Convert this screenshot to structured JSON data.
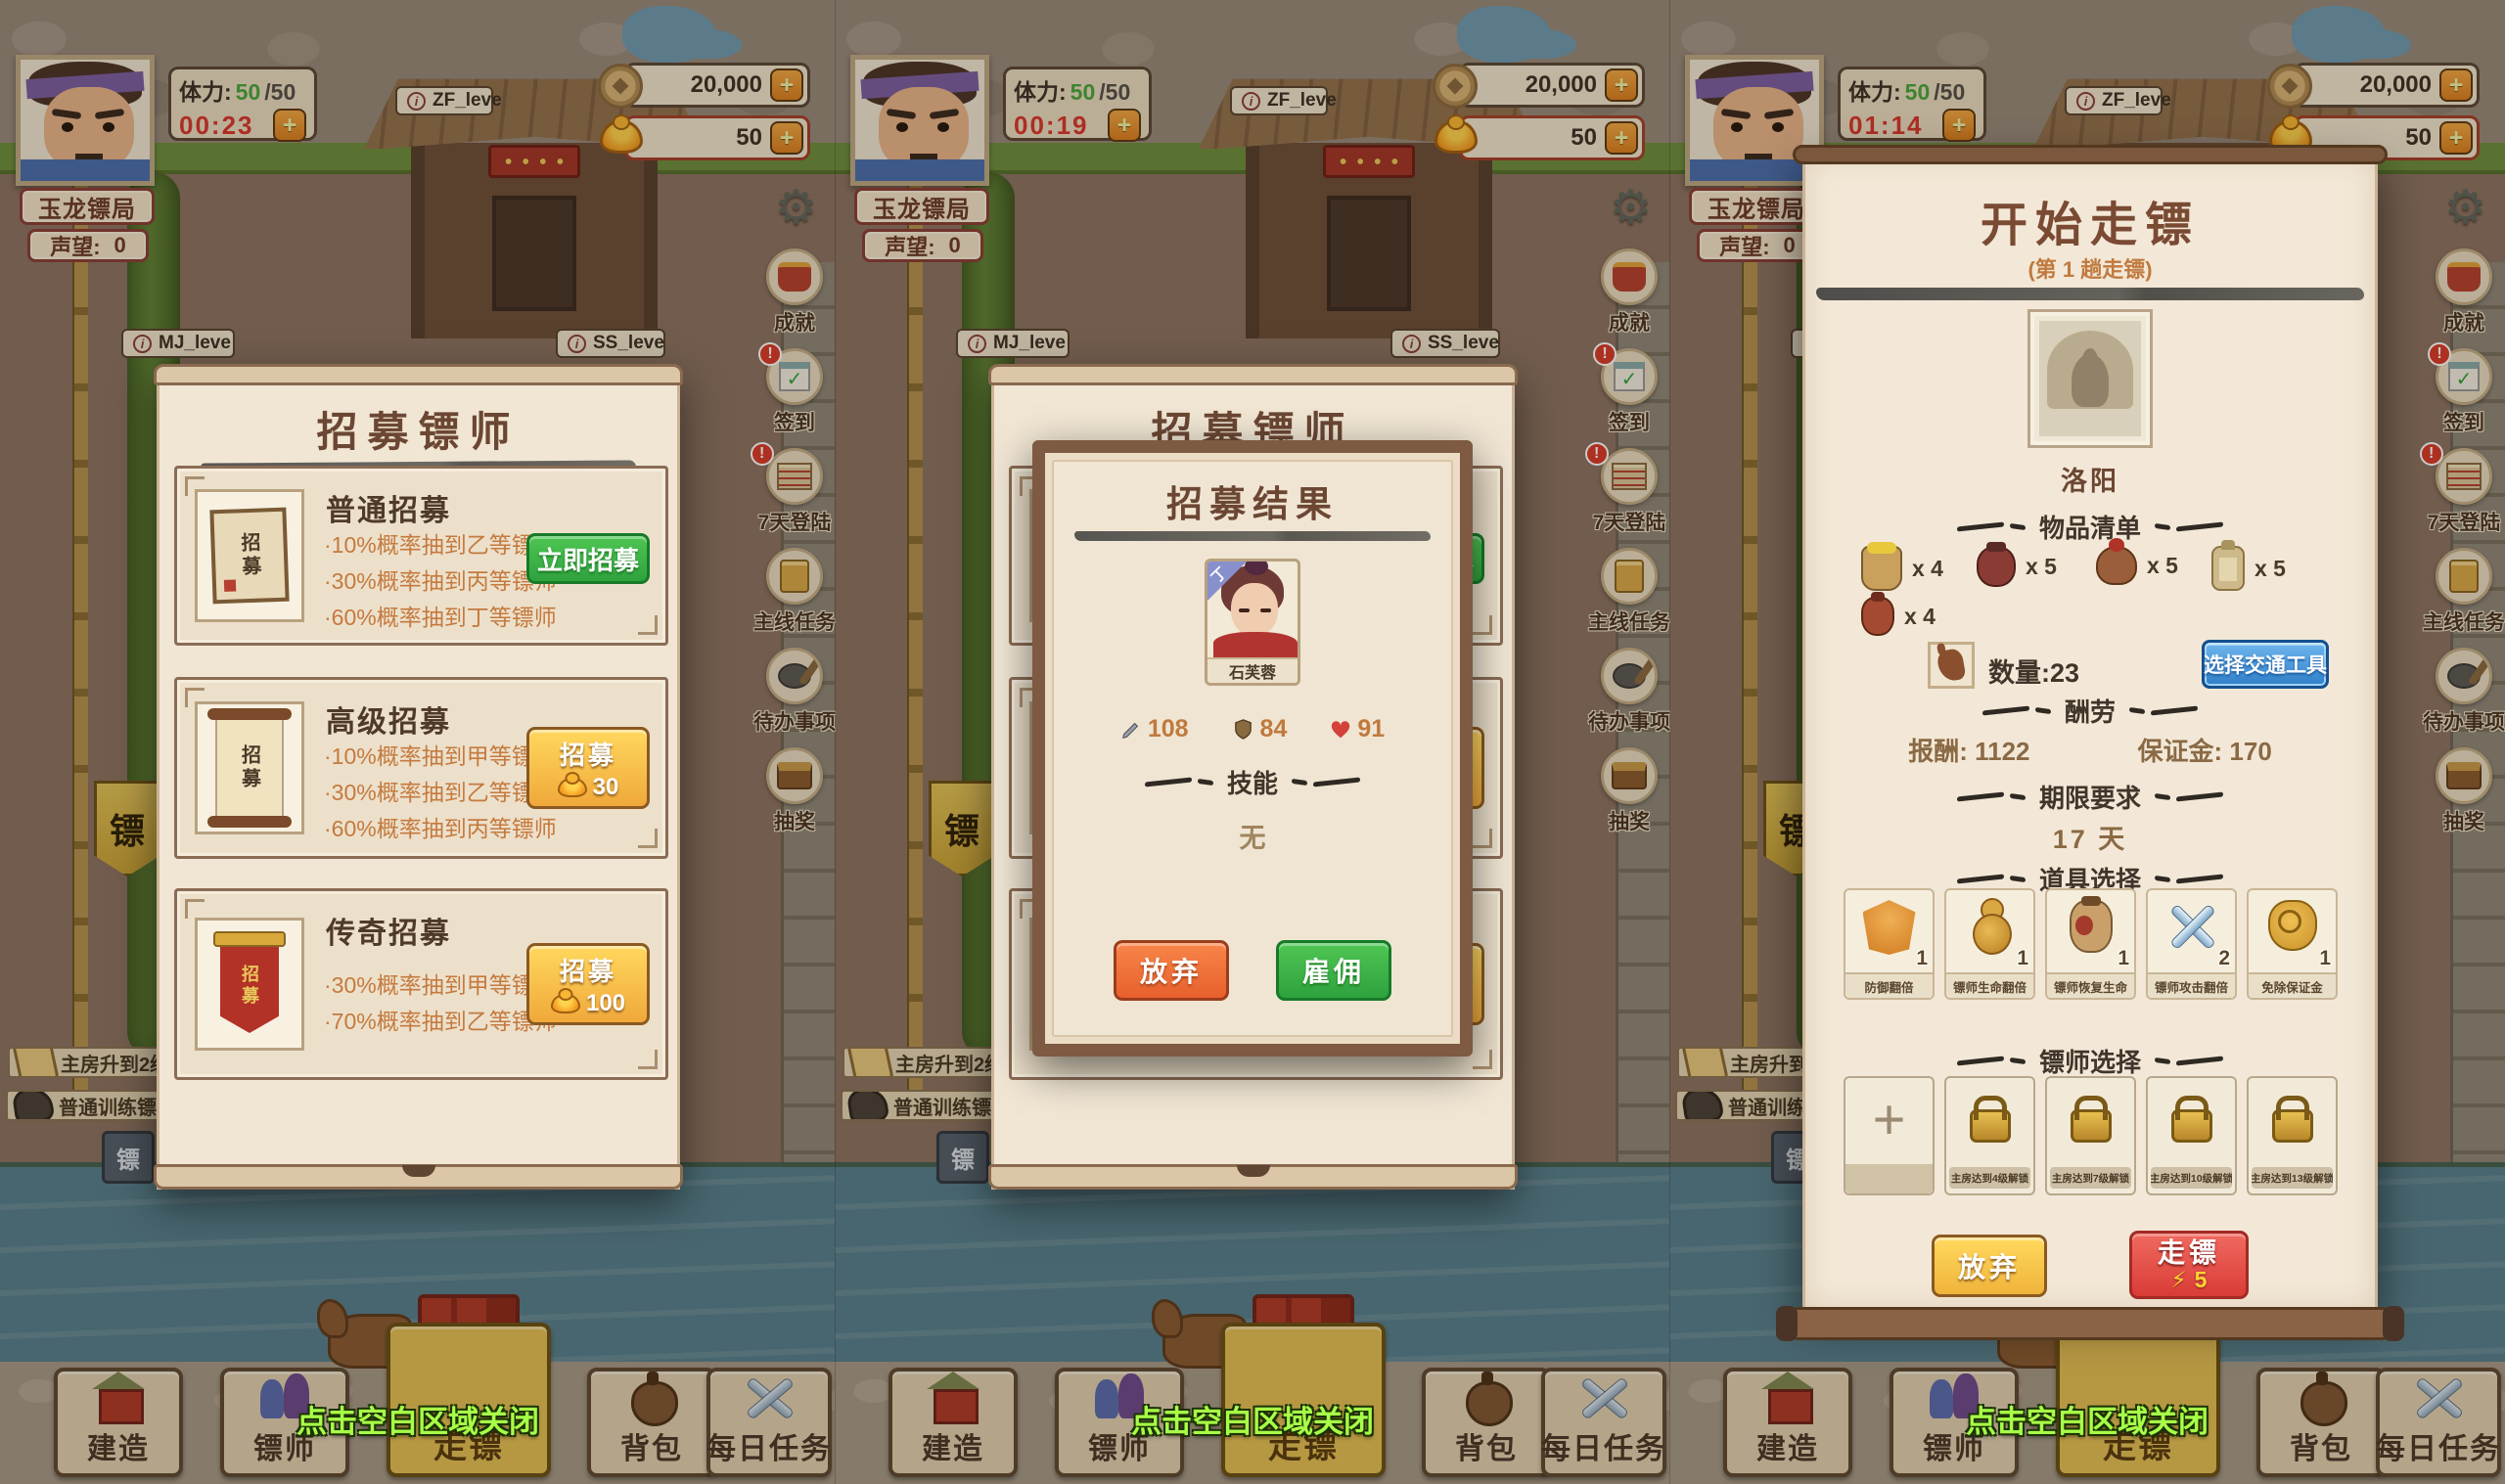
{
  "icons": {
    "plus": "+",
    "info": "i",
    "gear": "⚙",
    "lightning": "⚡",
    "slot_plus": "+",
    "check": "✓"
  },
  "panels": [
    {
      "timer": "00:23"
    },
    {
      "timer": "00:19"
    },
    {
      "timer": "01:14"
    }
  ],
  "header": {
    "guild_name": "玉龙镖局",
    "reputation_label": "声望:",
    "reputation_value": "0",
    "stamina_label": "体力:",
    "stamina_current": "50",
    "stamina_max": "/50",
    "zf_label": "ZF_leve",
    "mj_label": "MJ_leve",
    "ss_label": "SS_leve",
    "coins": "20,000",
    "gold": "50"
  },
  "side_icons": [
    {
      "label": "成就",
      "badge": ""
    },
    {
      "label": "签到",
      "badge": "!"
    },
    {
      "label": "7天登陆",
      "badge": "!"
    },
    {
      "label": "主线任务",
      "badge": ""
    },
    {
      "label": "待办事项",
      "badge": ""
    },
    {
      "label": "抽奖",
      "badge": ""
    }
  ],
  "left_side": {
    "flag": "镖",
    "task1": "主房升到2级",
    "task2": "普通训练镖师",
    "crate": "镖"
  },
  "recruit": {
    "title": "招募镖师",
    "cards": [
      {
        "name": "普通招募",
        "icon_text": "招募",
        "lines": [
          "·10%概率抽到乙等镖师",
          "·30%概率抽到丙等镖师",
          "·60%概率抽到丁等镖师"
        ],
        "button": "立即招募",
        "cost": ""
      },
      {
        "name": "高级招募",
        "icon_text": "招募",
        "lines": [
          "·10%概率抽到甲等镖师",
          "·30%概率抽到乙等镖师",
          "·60%概率抽到丙等镖师"
        ],
        "button": "招募",
        "cost": "30"
      },
      {
        "name": "传奇招募",
        "icon_text": "招募",
        "lines": [
          "·30%概率抽到甲等镖师",
          "·70%概率抽到乙等镖师"
        ],
        "button": "招募",
        "cost": "100"
      }
    ]
  },
  "result": {
    "title": "招募结果",
    "grade": "丁",
    "name": "石芙蓉",
    "atk": "108",
    "def": "84",
    "hp": "91",
    "skill_header": "技能",
    "skill_none": "无",
    "give_up": "放弃",
    "hire": "雇佣"
  },
  "escort": {
    "title": "开始走镖",
    "subtitle": "(第 1 趟走镖)",
    "destination": "洛阳",
    "goods_header": "物品清单",
    "goods": [
      "x 4",
      "x 5",
      "x 5",
      "x 5",
      "x 4"
    ],
    "quantity": "数量:23",
    "transport_button": "选择交通工具",
    "pay_header": "酬劳",
    "pay": "报酬: 1122",
    "deposit": "保证金: 170",
    "deadline_header": "期限要求",
    "deadline": "17 天",
    "items_header": "道具选择",
    "items": [
      {
        "label": "防御翻倍",
        "count": "1"
      },
      {
        "label": "镖师生命翻倍",
        "count": "1"
      },
      {
        "label": "镖师恢复生命",
        "count": "1"
      },
      {
        "label": "镖师攻击翻倍",
        "count": "2"
      },
      {
        "label": "免除保证金",
        "count": "1"
      }
    ],
    "escorts_header": "镖师选择",
    "slots": [
      "主房达到4级解锁",
      "主房达到7级解锁",
      "主房达到10级解锁",
      "主房达到13级解锁"
    ],
    "give_up": "放弃",
    "go": "走镖",
    "go_cost": "5"
  },
  "nav": {
    "items": [
      "建造",
      "镖师",
      "走镖",
      "背包",
      "每日任务"
    ],
    "tip": "点击空白区域关闭"
  }
}
